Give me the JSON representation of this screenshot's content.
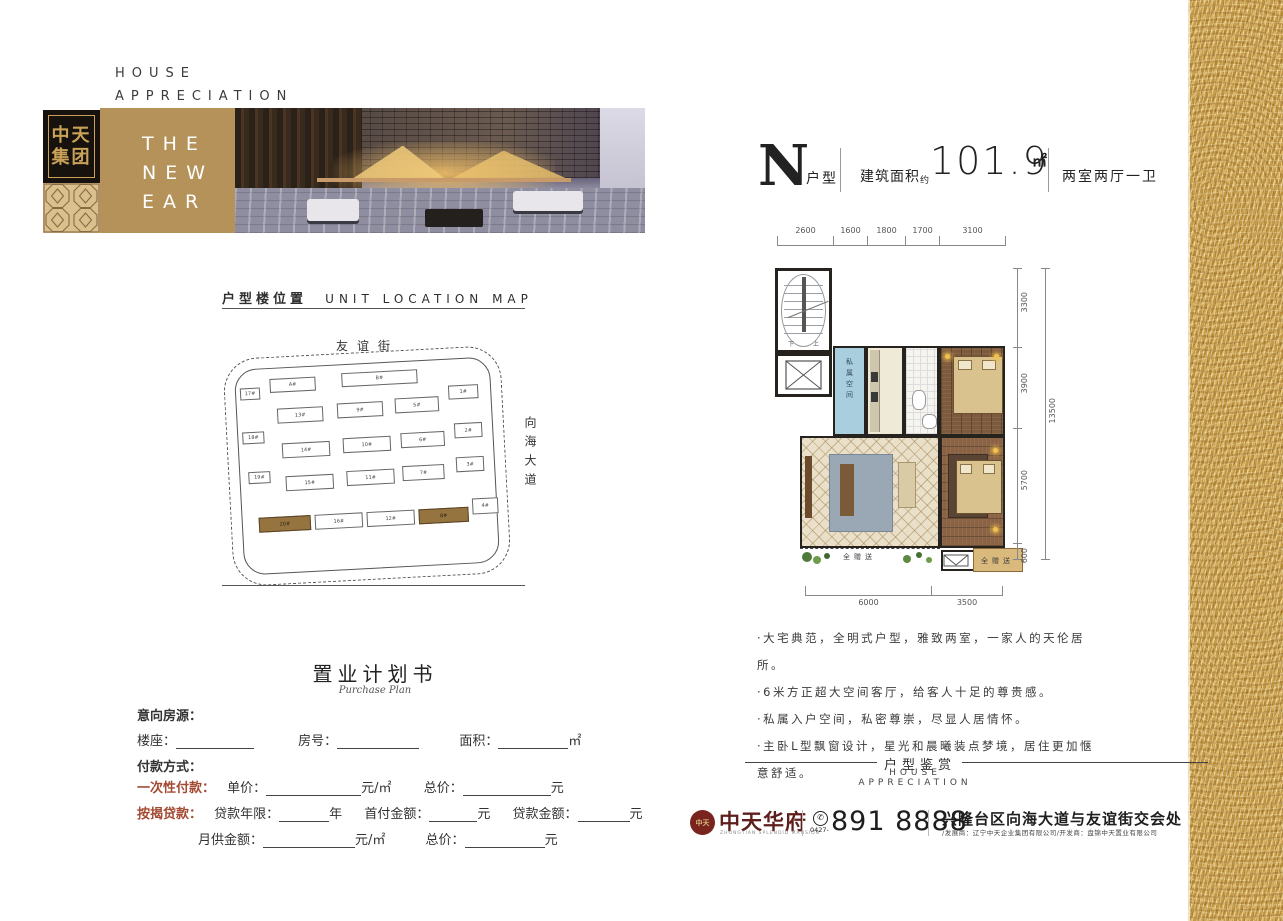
{
  "header": {
    "tagline": [
      "HOUSE",
      "APPRECIATION"
    ],
    "logo": {
      "line1": "中天",
      "line2": "集团"
    },
    "banner": [
      "THE",
      "NEW",
      "EAR"
    ]
  },
  "unit": {
    "letter": "N",
    "letter_suffix": "户型",
    "area_label": "建筑面积",
    "area_approx": "约",
    "area_value": "101.9",
    "area_unit": "㎡",
    "rooms": "两室两厅一卫"
  },
  "floorplan": {
    "dims_top": [
      "2600",
      "1600",
      "1800",
      "1700",
      "3100"
    ],
    "dims_right": [
      "3300",
      "3900",
      "5700",
      "600"
    ],
    "dims_total": "13500",
    "dims_bottom": [
      "6000",
      "3500"
    ],
    "room_labels": {
      "private": "私属空间",
      "gift_left": "全赠送",
      "gift_right": "全赠送",
      "stair_down": "下",
      "stair_up": "上"
    }
  },
  "selling_points": [
    "·大宅典范，全明式户型，雅致两室，一家人的天伦居所。",
    "·6米方正超大空间客厅，给客人十足的尊贵感。",
    "·私属入户空间，私密尊崇，尽显人居情怀。",
    "·主卧L型飘窗设计，星光和晨曦装点梦境，居住更加惬意舒适。"
  ],
  "location_map": {
    "title_cn": "户型楼位置",
    "title_en": "UNIT LOCATION MAP",
    "street_top": "友谊街",
    "street_right": "向海大道",
    "highlight_color": "#96743f",
    "buildings": [
      {
        "label": "17#",
        "x": 16,
        "y": 30,
        "w": 18,
        "h": 10
      },
      {
        "label": "A#",
        "x": 46,
        "y": 22,
        "w": 44,
        "h": 12
      },
      {
        "label": "B#",
        "x": 118,
        "y": 20,
        "w": 74,
        "h": 12
      },
      {
        "label": "1#",
        "x": 224,
        "y": 38,
        "w": 28,
        "h": 12
      },
      {
        "label": "13#",
        "x": 52,
        "y": 52,
        "w": 44,
        "h": 13
      },
      {
        "label": "9#",
        "x": 112,
        "y": 50,
        "w": 44,
        "h": 13
      },
      {
        "label": "5#",
        "x": 170,
        "y": 48,
        "w": 42,
        "h": 13
      },
      {
        "label": "18#",
        "x": 16,
        "y": 74,
        "w": 20,
        "h": 10
      },
      {
        "label": "14#",
        "x": 55,
        "y": 87,
        "w": 46,
        "h": 13
      },
      {
        "label": "10#",
        "x": 116,
        "y": 85,
        "w": 46,
        "h": 13
      },
      {
        "label": "6#",
        "x": 174,
        "y": 83,
        "w": 42,
        "h": 13
      },
      {
        "label": "2#",
        "x": 228,
        "y": 76,
        "w": 26,
        "h": 13
      },
      {
        "label": "19#",
        "x": 20,
        "y": 114,
        "w": 20,
        "h": 10
      },
      {
        "label": "15#",
        "x": 57,
        "y": 120,
        "w": 46,
        "h": 13
      },
      {
        "label": "11#",
        "x": 118,
        "y": 118,
        "w": 46,
        "h": 13
      },
      {
        "label": "7#",
        "x": 174,
        "y": 116,
        "w": 40,
        "h": 13
      },
      {
        "label": "3#",
        "x": 228,
        "y": 110,
        "w": 26,
        "h": 13
      },
      {
        "label": "20#",
        "x": 28,
        "y": 160,
        "w": 50,
        "h": 13,
        "hl": true
      },
      {
        "label": "16#",
        "x": 84,
        "y": 160,
        "w": 46,
        "h": 13
      },
      {
        "label": "12#",
        "x": 136,
        "y": 160,
        "w": 46,
        "h": 13
      },
      {
        "label": "8#",
        "x": 188,
        "y": 160,
        "w": 48,
        "h": 13,
        "hl": true
      },
      {
        "label": "4#",
        "x": 242,
        "y": 152,
        "w": 24,
        "h": 14
      }
    ]
  },
  "purchase_plan": {
    "title": "置业计划书",
    "subtitle": "Purchase Plan",
    "intent": "意向房源：",
    "building_label": "楼座：",
    "room_label": "房号：",
    "area_label": "面积：",
    "area_suffix": "㎡",
    "payment": "付款方式：",
    "onetime_label": "一次性付款：",
    "unit_price": "单价：",
    "unit_price_suffix": "元/㎡",
    "total_label": "总价：",
    "total_suffix": "元",
    "mortgage_label": "按揭贷款：",
    "loan_years": "贷款年限：",
    "loan_years_suffix": "年",
    "down_payment": "首付金额：",
    "down_suffix": "元",
    "loan_amount": "贷款金额：",
    "loan_suffix": "元",
    "monthly": "月供金额：",
    "monthly_suffix": "元/㎡",
    "total2_label": "总价：",
    "total2_suffix": "元"
  },
  "appreciation": {
    "cn": "户型鉴赏",
    "en": "HOUSE APPRECIATION"
  },
  "footer": {
    "seal": "中天",
    "brand": "中天华府",
    "brand_sub": "ZHONGTIAN SPLENDID MANSION",
    "area_code": "0427-",
    "phone": "891 8888",
    "address": "兴隆台区向海大道与友谊街交会处",
    "developers": "/发展商：辽宁中天企业集团有限公司/开发商：盘锦中天置业有限公司"
  }
}
